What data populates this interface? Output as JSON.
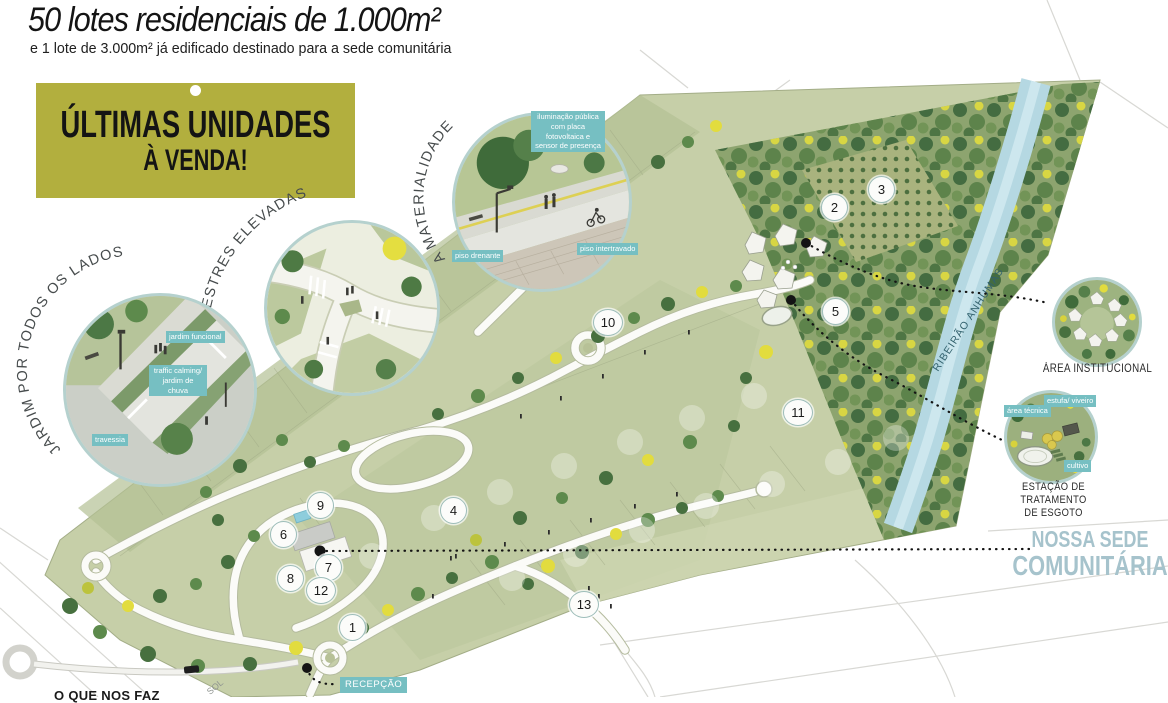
{
  "header": {
    "title": "50 lotes residenciais de 1.000m²",
    "subtitle": "e 1 lote de 3.000m² já edificado destinado para a sede comunitária"
  },
  "banner": {
    "line1": "ÚLTIMAS UNIDADES",
    "line2": "À VENDA!"
  },
  "callouts": {
    "jardim": {
      "title": "JARDIM POR TODOS OS LADOS",
      "labels": [
        "jardim funcional",
        "traffic calming/ jardim de chuva",
        "travessia"
      ]
    },
    "faixas": {
      "title": "FAIXAS DE PEDESTRES ELEVADAS"
    },
    "materialidade": {
      "title": "A MATERIALIDADE",
      "labels": [
        "iluminação pública com placa fotovoltaica e sensor de presença",
        "piso drenante",
        "piso intertravado"
      ]
    },
    "institucional": {
      "caption": "ÁREA INSTITUCIONAL"
    },
    "ete": {
      "caption_line1": "ESTAÇÃO DE TRATAMENTO",
      "caption_line2": "DE ESGOTO",
      "labels": [
        "área técnica",
        "estufa/ viveiro",
        "cultivo"
      ]
    },
    "sede": {
      "line1": "NOSSA SEDE",
      "line2": "COMUNITÁRIA"
    },
    "recepcao": {
      "label": "RECEPÇÃO"
    }
  },
  "map": {
    "river_label": "RIBEIRÃO ANHUMAS",
    "street_label": "SOL",
    "bottom_partial_text": "O QUE NOS FAZ",
    "markers": [
      "1",
      "2",
      "3",
      "4",
      "5",
      "6",
      "7",
      "8",
      "9",
      "10",
      "11",
      "12",
      "13"
    ]
  },
  "colors": {
    "banner_bg": "#b2af3e",
    "label_chip": "#76bfc2",
    "sede_text": "#a6c3cc",
    "river": "#b5d8e2",
    "site_green": "#c6cfa8",
    "forest_green": "#90a673",
    "accent_yellow": "#e2dc3e"
  }
}
